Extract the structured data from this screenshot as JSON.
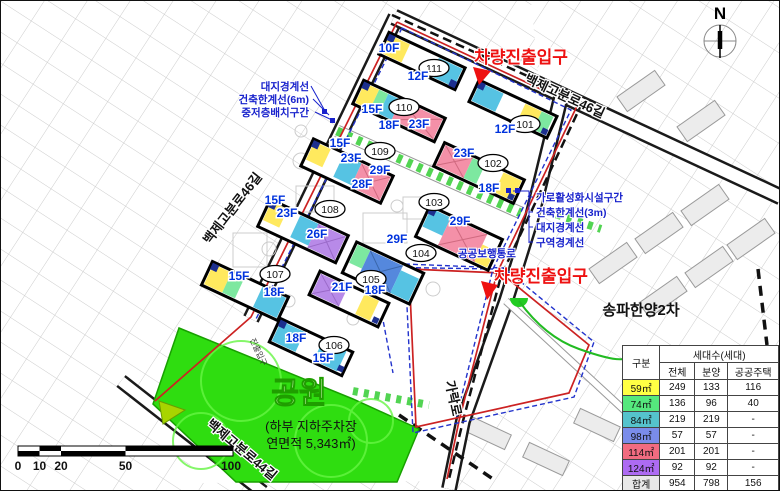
{
  "map": {
    "north_label": "N",
    "roads": {
      "left": "백제고분로46길",
      "top": "백제고분로46길",
      "bottom": "백제고분로44길",
      "right": "가락로"
    },
    "entrances": [
      {
        "label": "차량진출입구"
      },
      {
        "label": "차량진출입구"
      }
    ],
    "walkway_label": "공공보행통로",
    "park": {
      "name": "공원",
      "sub1": "(하부 지하주차장",
      "sub2": "연면적 5,343㎡)",
      "small_label": "진출입구"
    },
    "neighbor_label": "송파한양2차",
    "annotations_left": [
      "대지경계선",
      "건축한계선(6m)",
      "중저층배치구간"
    ],
    "annotations_right": [
      "가로활성화시설구간",
      "건축한계선(3m)",
      "대지경계선",
      "구역경계선"
    ],
    "buildings": [
      {
        "no": "101",
        "floors": [
          "12F"
        ]
      },
      {
        "no": "102",
        "floors": [
          "23F",
          "18F"
        ]
      },
      {
        "no": "103",
        "floors": [
          "29F"
        ]
      },
      {
        "no": "104",
        "floors": [
          "29F"
        ]
      },
      {
        "no": "105",
        "floors": [
          "21F",
          "18F"
        ]
      },
      {
        "no": "106",
        "floors": [
          "18F",
          "15F"
        ]
      },
      {
        "no": "107",
        "floors": [
          "15F",
          "18F"
        ]
      },
      {
        "no": "108",
        "floors": [
          "15F",
          "23F",
          "26F"
        ]
      },
      {
        "no": "109",
        "floors": [
          "15F",
          "23F",
          "29F",
          "28F"
        ]
      },
      {
        "no": "110",
        "floors": [
          "15F",
          "18F",
          "23F"
        ]
      },
      {
        "no": "111",
        "floors": [
          "10F",
          "12F"
        ]
      }
    ],
    "scalebar": {
      "ticks": [
        "0",
        "10",
        "20",
        "50",
        "100"
      ]
    },
    "colors": {
      "entrance_red": "#ee1111",
      "floor_label_blue": "#0033dd",
      "park_green": "#2fdd10",
      "boundary_red": "#cc2222",
      "boundary_blue": "#2233cc",
      "walkway_green": "#52d452"
    }
  },
  "table": {
    "col_group_header": "세대수(세대)",
    "col_headers": {
      "group": "구분",
      "total": "전체",
      "sale": "분양",
      "public": "공공주택"
    },
    "rows": [
      {
        "label": "59㎡",
        "color": "#ffff44",
        "total": "249",
        "sale": "133",
        "public": "116"
      },
      {
        "label": "74㎡",
        "color": "#55e87d",
        "total": "136",
        "sale": "96",
        "public": "40"
      },
      {
        "label": "84㎡",
        "color": "#55c3cc",
        "total": "219",
        "sale": "219",
        "public": "-"
      },
      {
        "label": "98㎡",
        "color": "#7a8cea",
        "total": "57",
        "sale": "57",
        "public": "-"
      },
      {
        "label": "114㎡",
        "color": "#f26b80",
        "total": "201",
        "sale": "201",
        "public": "-"
      },
      {
        "label": "124㎡",
        "color": "#ad6bf2",
        "total": "92",
        "sale": "92",
        "public": "-"
      },
      {
        "label": "합계",
        "color": "#e8e8e8",
        "total": "954",
        "sale": "798",
        "public": "156"
      }
    ]
  }
}
